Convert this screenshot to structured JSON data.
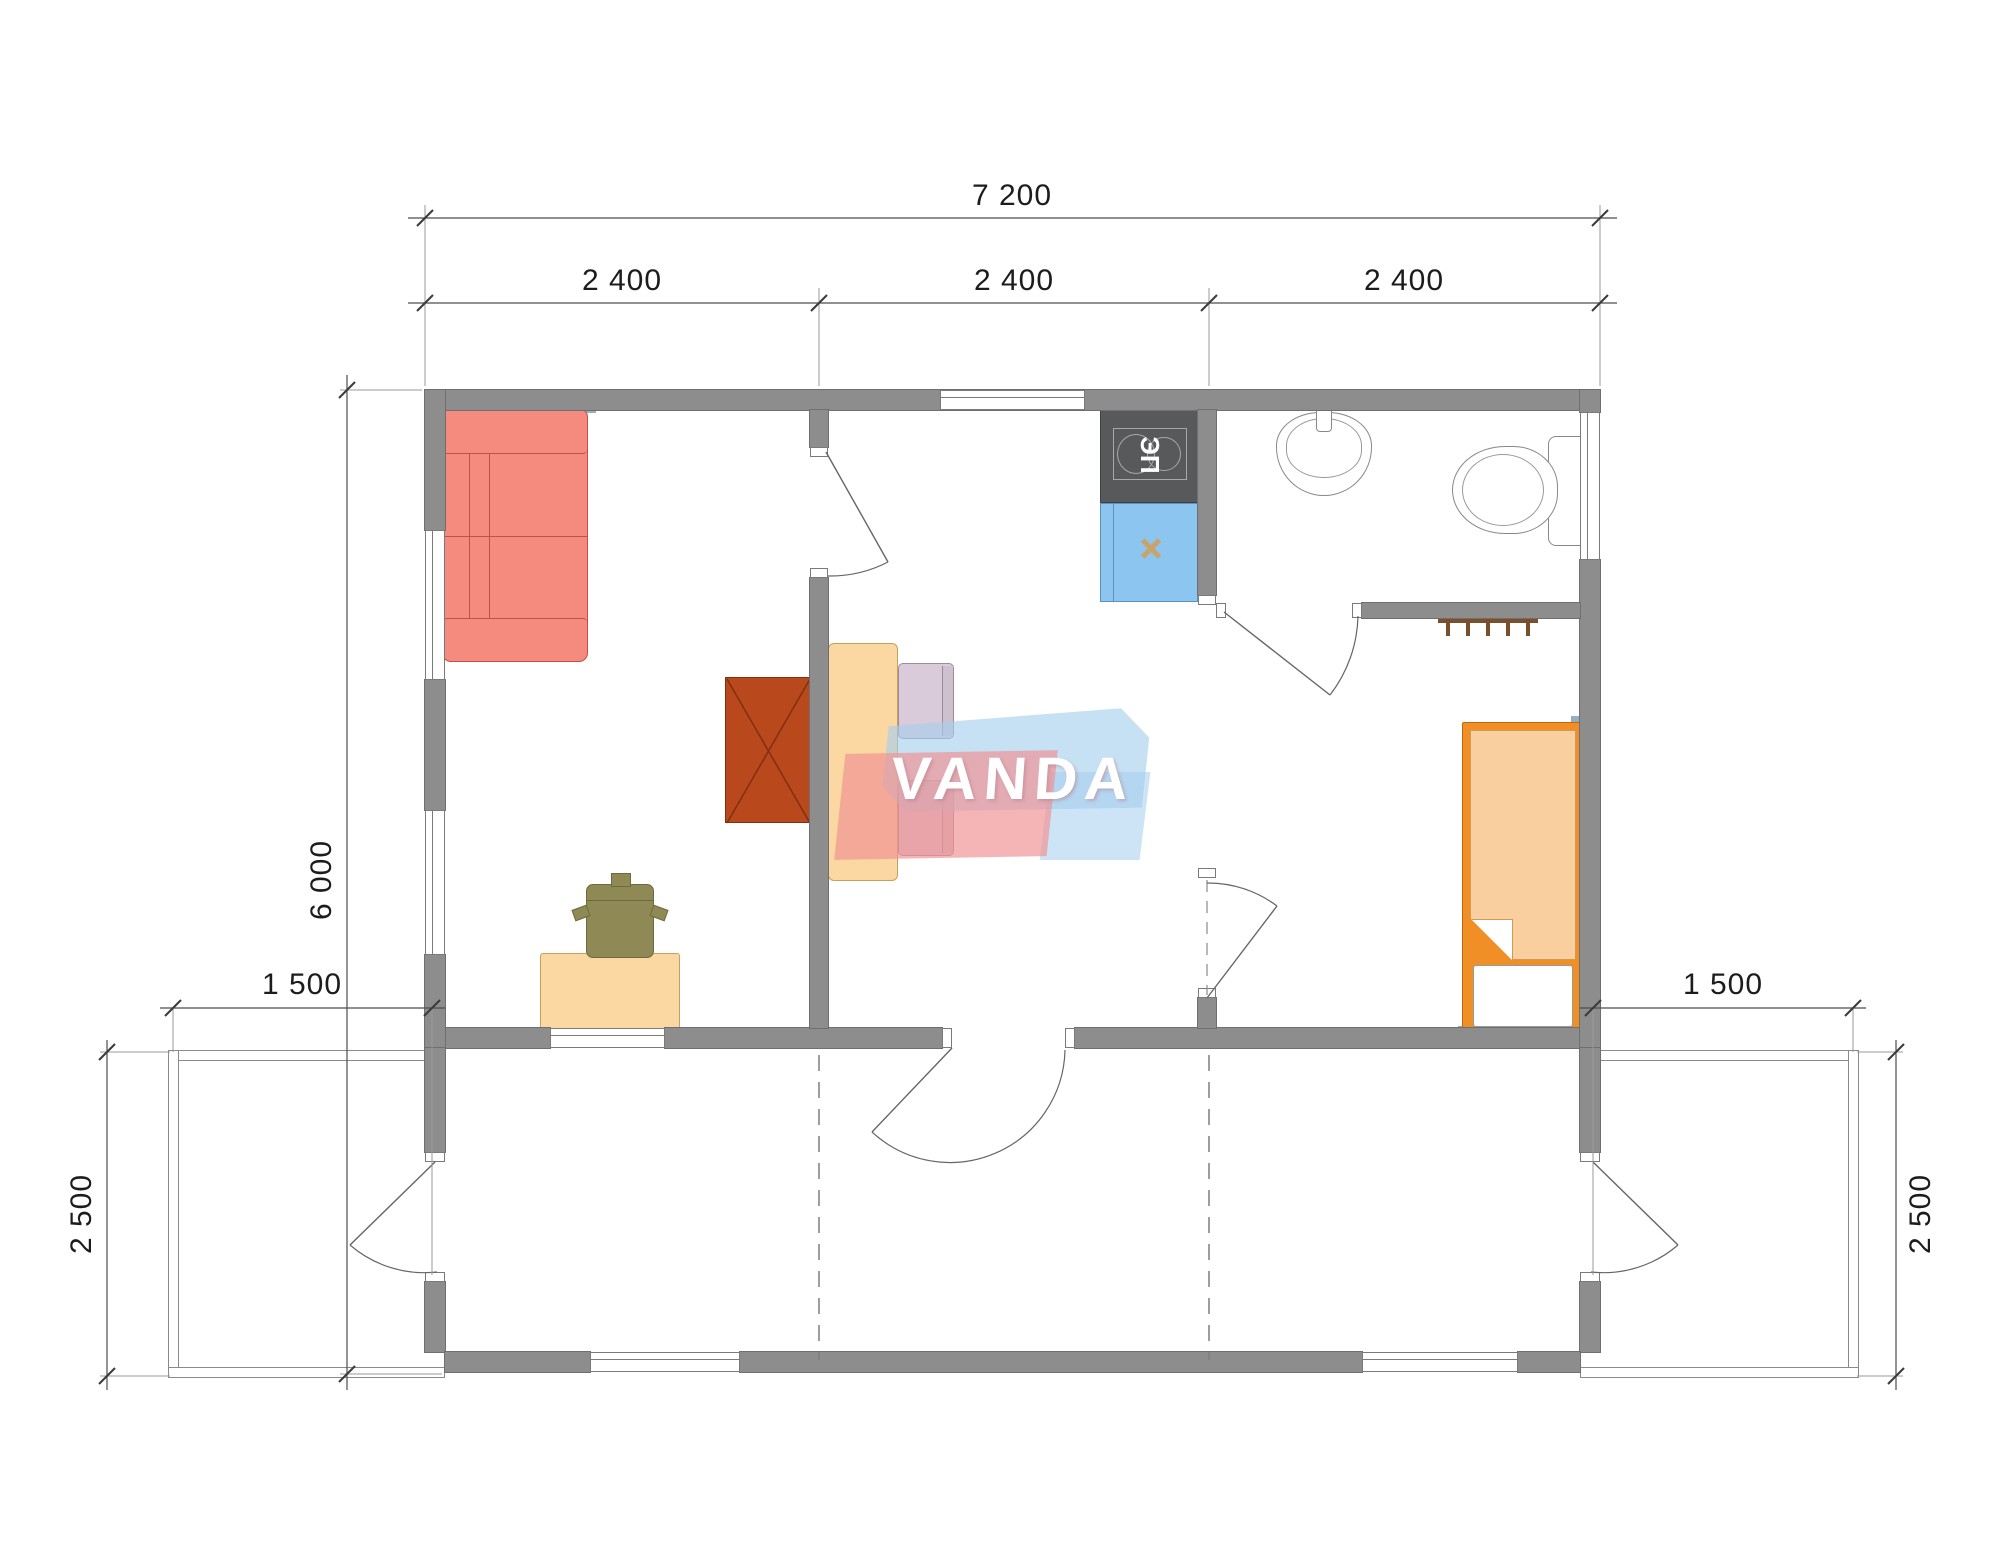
{
  "drawing": {
    "kind": "floor-plan",
    "watermark_brand": "VANDA"
  },
  "dimensions": {
    "overall_width": "7 200",
    "bay1_width": "2 400",
    "bay2_width": "2 400",
    "bay3_width": "2 400",
    "overall_depth": "6 000",
    "terrace_left_width": "1 500",
    "terrace_right_width": "1 500",
    "terrace_left_depth": "2 500",
    "terrace_right_depth": "2 500"
  },
  "appliances": {
    "stove_label": "ЭП"
  },
  "colors": {
    "wall": "#8d8d8d",
    "wall_lining": "#93afc0",
    "sofa": "#f58a7e",
    "desk_table": "#fbd7a2",
    "office_chair": "#8f8a55",
    "cabinet": "#b9491c",
    "dining_chair": "#d9cbd9",
    "stove": "#58595b",
    "kitchen_sink": "#8cc6f0",
    "bed_frame": "#ef8f25",
    "bed_blanket": "#f9cf9f",
    "logo_blue": "#a4ceee",
    "logo_red": "#f09294"
  }
}
